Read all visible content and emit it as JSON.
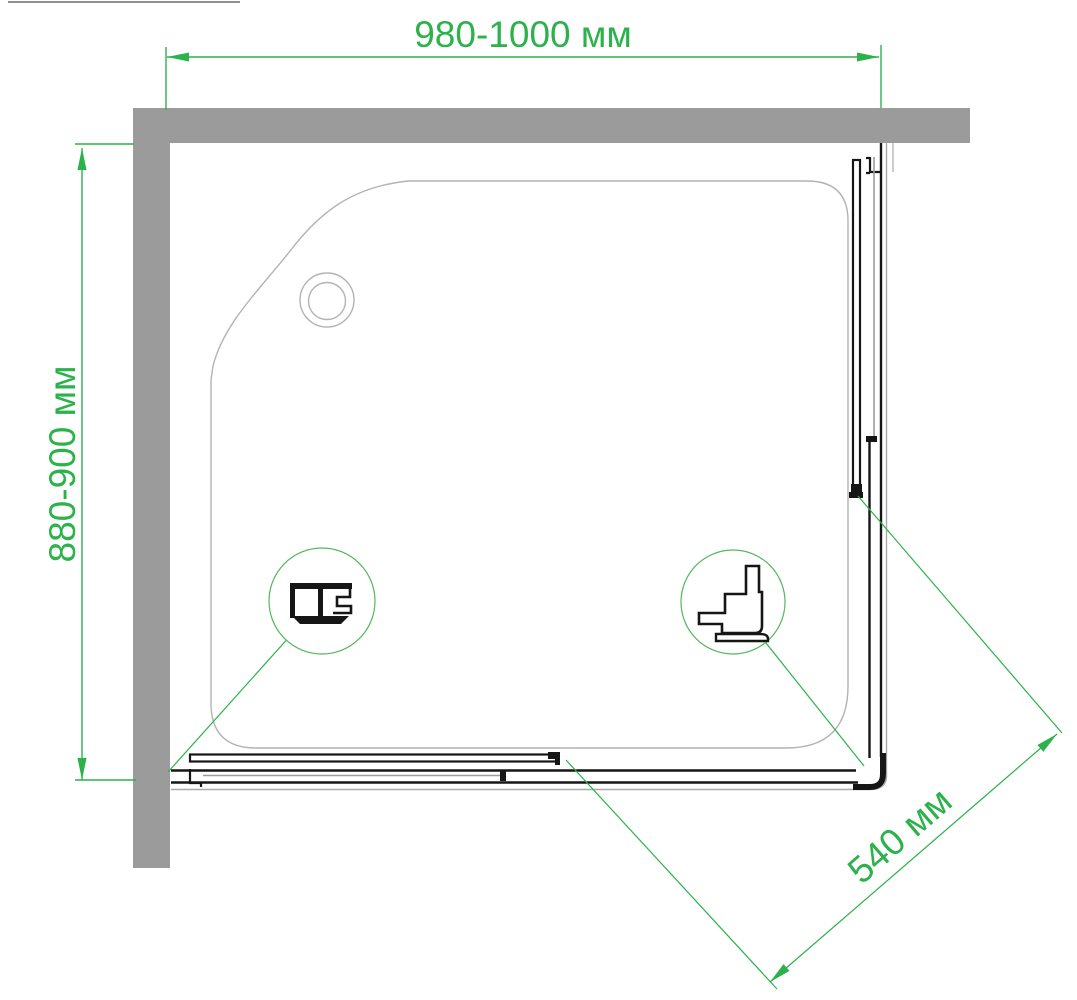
{
  "diagram": {
    "labels": {
      "width": "980-1000 мм",
      "depth": "880-900 мм",
      "entry": "540 мм"
    },
    "units": "мм",
    "colors": {
      "dimension_green": "#2bb24a",
      "wall_gray": "#9b9b9b",
      "profile_black": "#161616",
      "tray_outline_gray": "#b3b3b3",
      "frame_gray": "#a9a9a9"
    }
  }
}
